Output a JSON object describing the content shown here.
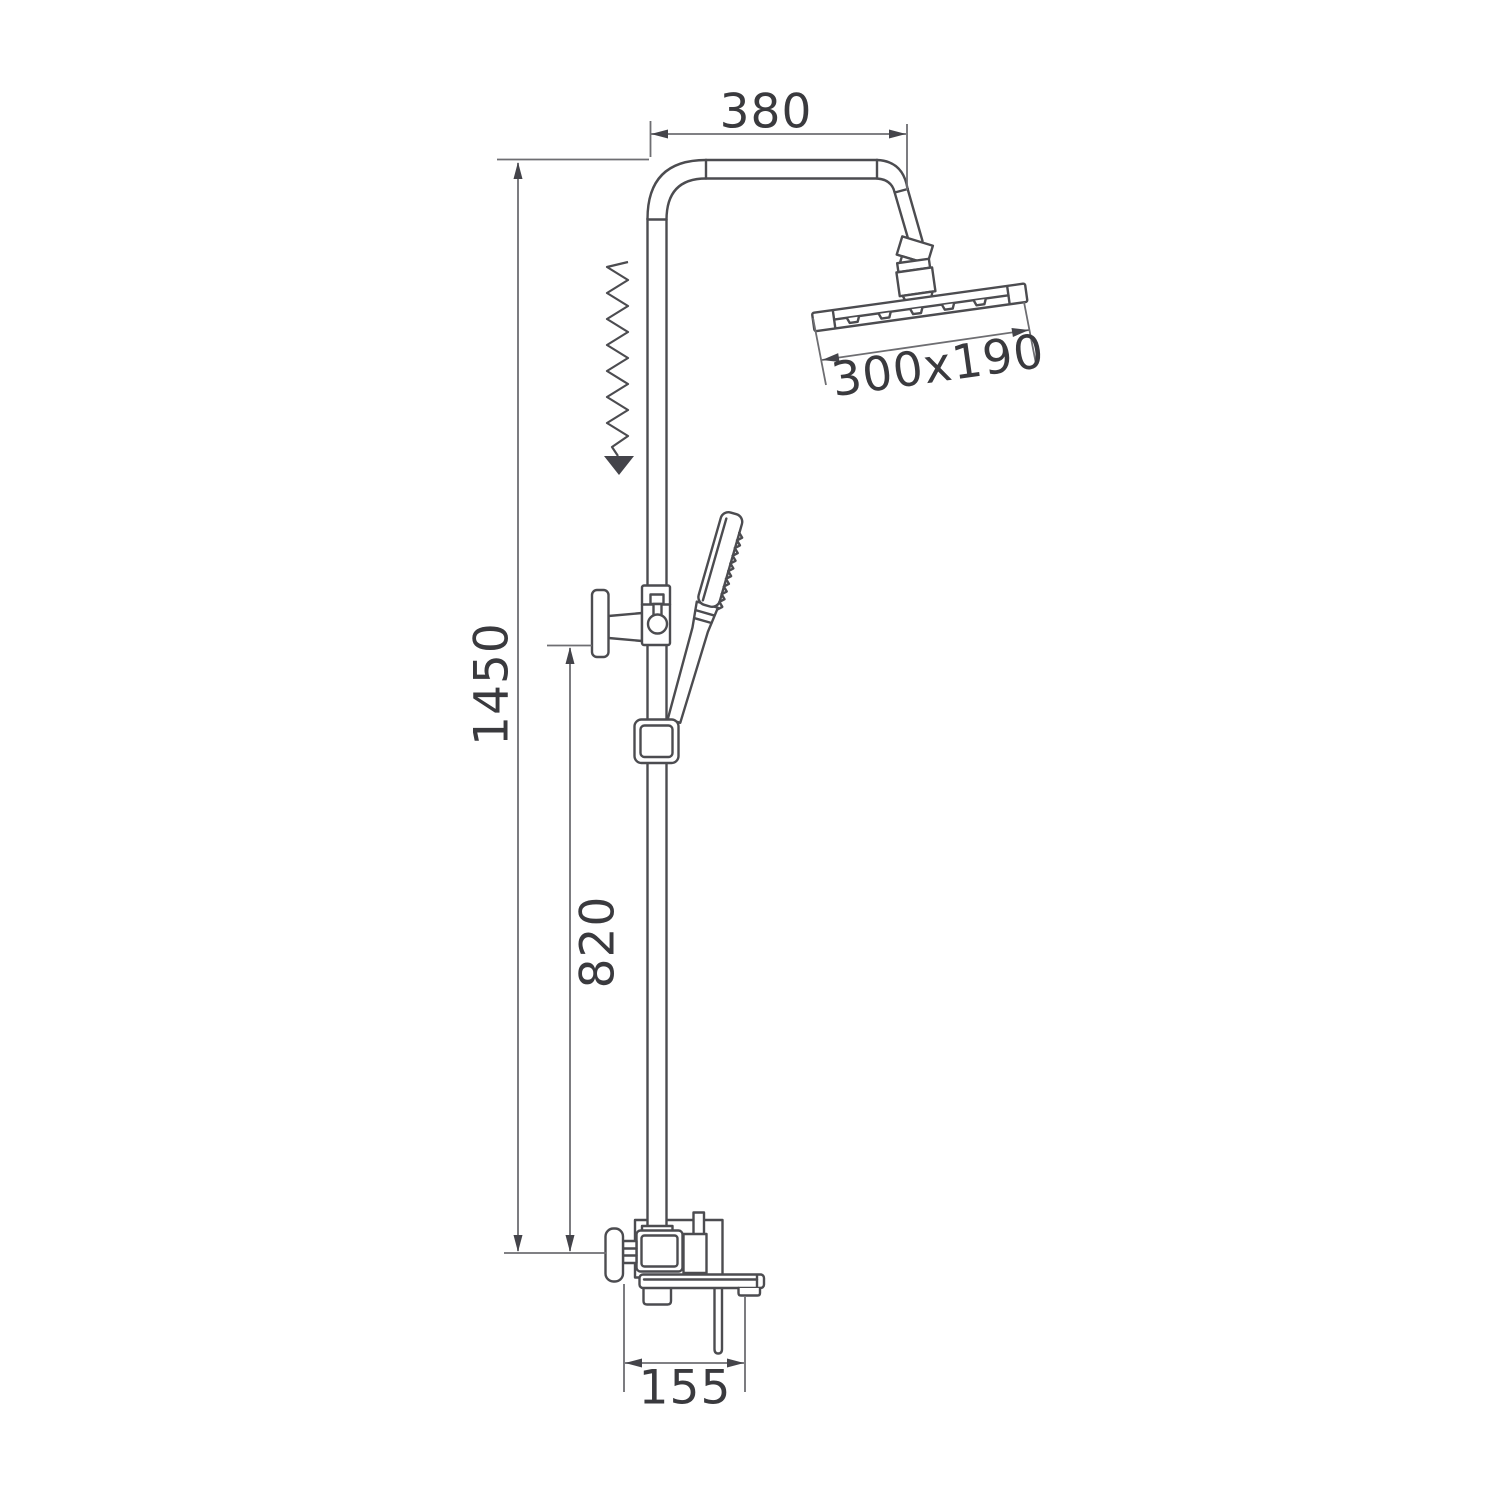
{
  "canvas": {
    "background": "#ffffff"
  },
  "drawing": {
    "line_color": "#4c4c50",
    "dimension_line_color": "#6e6e72",
    "arrow_color": "#44444a",
    "text_color": "#3a3a3e",
    "labels": {
      "top_arm_width": "380",
      "rain_head_size": "300x190",
      "total_height": "1450",
      "column_height": "820",
      "spout_length": "155"
    }
  }
}
